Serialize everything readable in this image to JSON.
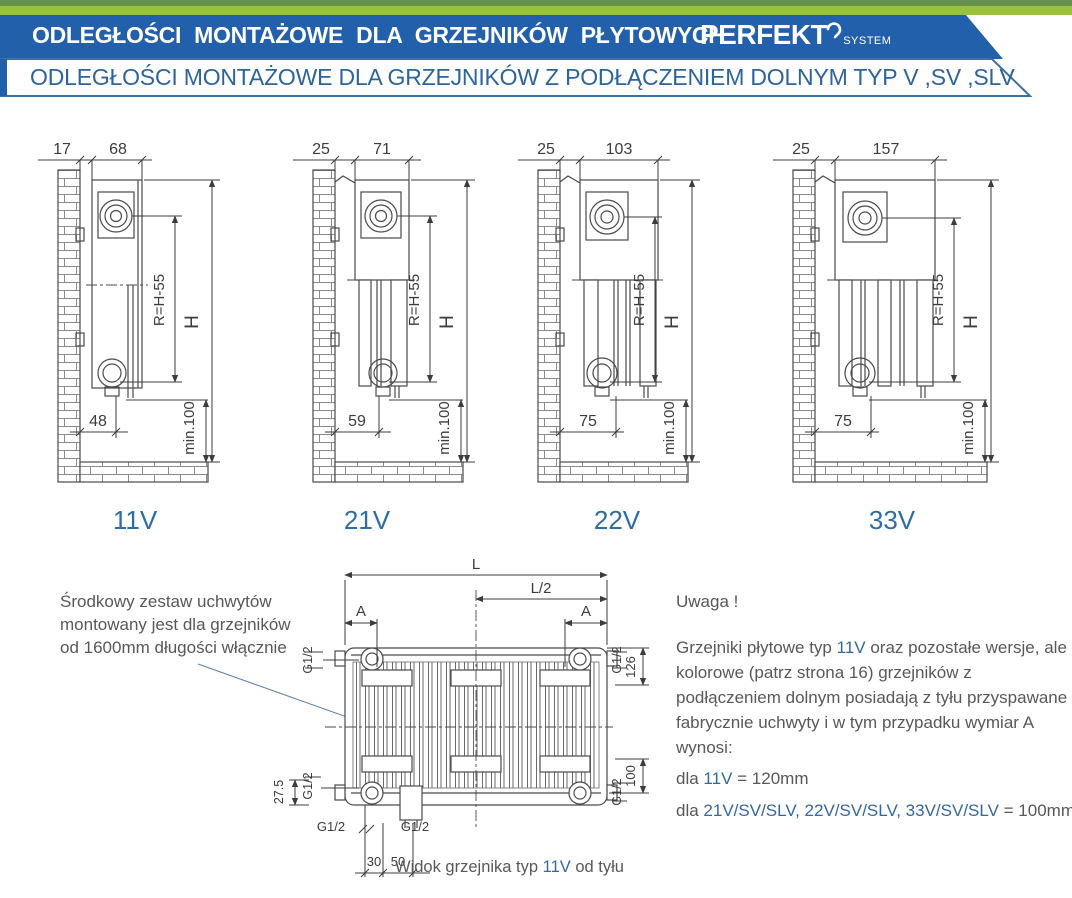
{
  "banner": {
    "title": "ODLEGŁOŚCI MONTAŻOWE DLA GRZEJNIKÓW PŁYTOWYCH",
    "brand": "PERFEKT",
    "brand_sub": "SYSTEM"
  },
  "subbanner": {
    "text": "ODLEGŁOŚCI MONTAŻOWE DLA GRZEJNIKÓW Z PODŁĄCZENIEM DOLNYM TYP V ,SV ,SLV"
  },
  "colors": {
    "banner_blue": "#2360ab",
    "accent_blue": "#2e6da4",
    "green_light": "#9bc23e",
    "green_dark": "#64924d",
    "line_gray": "#3c3c3c",
    "text_gray": "#57585a"
  },
  "drawings": {
    "shared": {
      "radius_label": "R=H-55",
      "height_label": "H",
      "min_label": "min.100"
    },
    "items": [
      {
        "type_label": "11V",
        "wall_gap": "17",
        "depth": "68",
        "bottom_offset": "48"
      },
      {
        "type_label": "21V",
        "wall_gap": "25",
        "depth": "71",
        "bottom_offset": "59"
      },
      {
        "type_label": "22V",
        "wall_gap": "25",
        "depth": "103",
        "bottom_offset": "75"
      },
      {
        "type_label": "33V",
        "wall_gap": "25",
        "depth": "157",
        "bottom_offset": "75"
      }
    ]
  },
  "note_left": {
    "line1": "Środkowy zestaw uchwytów",
    "line2": "montowany jest dla grzejników",
    "line3": "od 1600mm długości włącznie"
  },
  "rear_view": {
    "length": "L",
    "half_length": "L/2",
    "bracket_offset": "A",
    "thread": "G1/2",
    "dim_126": "126",
    "dim_100": "100",
    "dim_27_5": "27.5",
    "dim_30": "30",
    "dim_50": "50",
    "caption_prefix": "Widok grzejnika typ ",
    "caption_type": "11V",
    "caption_suffix": " od tyłu"
  },
  "note_right": {
    "title": "Uwaga !",
    "p1_prefix": "Grzejniki płytowe typ ",
    "p1_type": "11V",
    "p1_rest": " oraz pozostałe wersje, ale kolorowe (patrz strona 16) grzejników z podłączeniem dolnym posiadają z tyłu przyspawane fabrycznie uchwyty i w tym przypadku wymiar A wynosi:",
    "dla1": "dla ",
    "v11": "11V",
    "v11_val": " = 120mm",
    "dla2": "dla ",
    "rest_types": "21V/SV/SLV, 22V/SV/SLV, 33V/SV/SLV",
    "rest_val": " = 100mm"
  }
}
